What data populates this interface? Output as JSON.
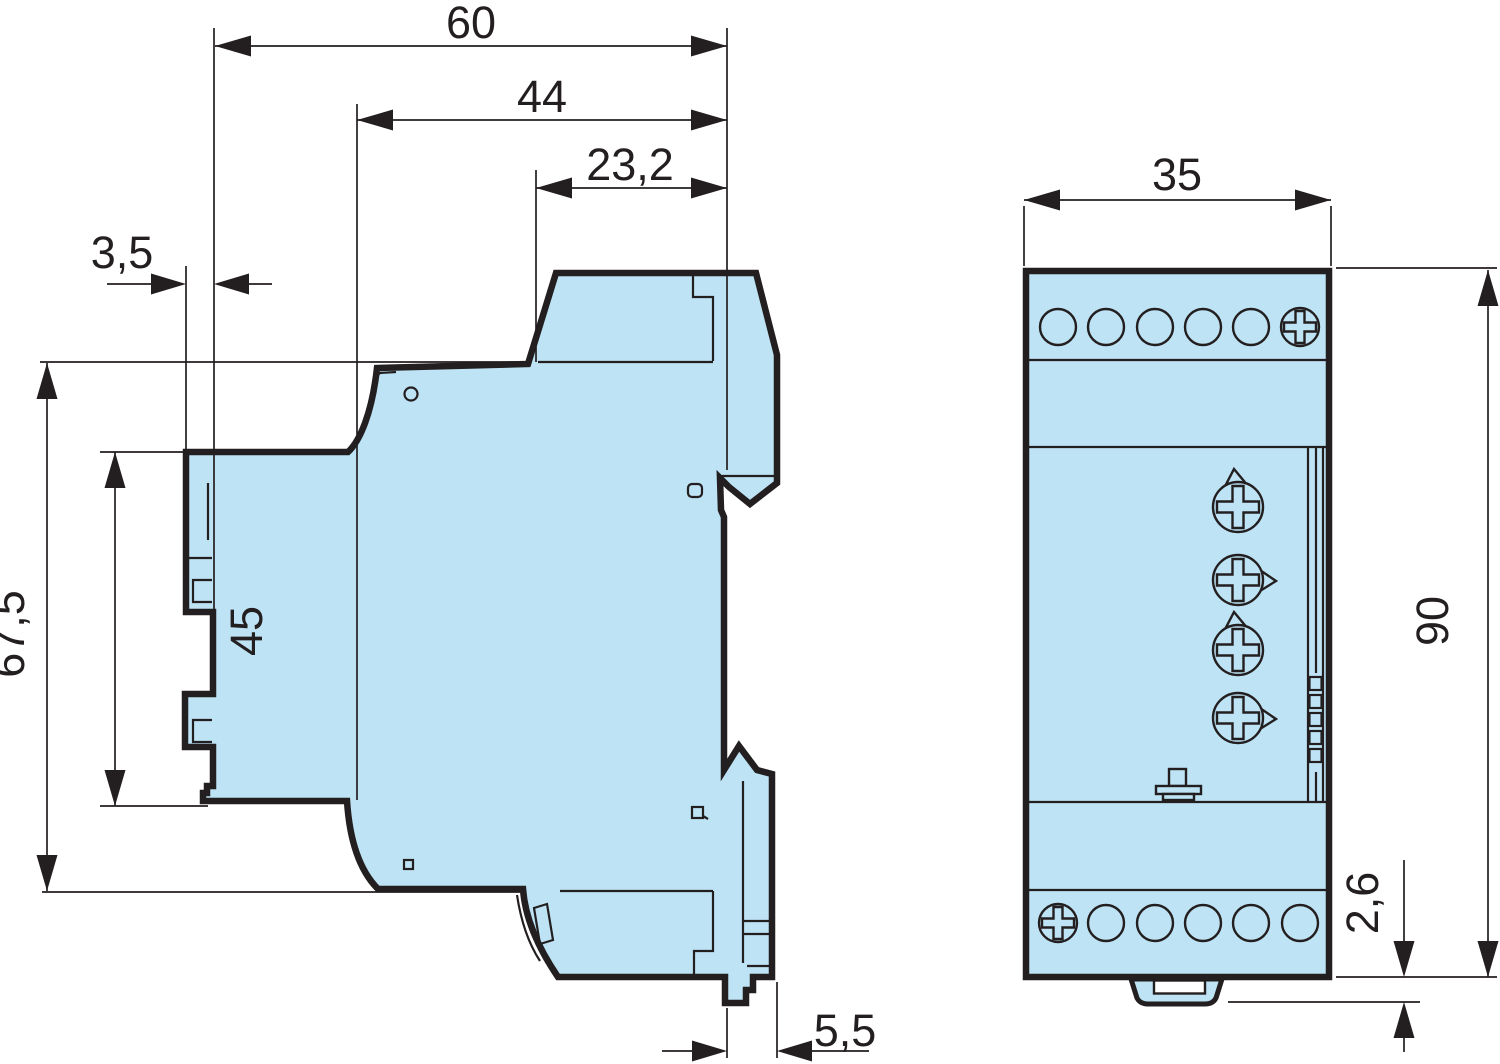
{
  "colors": {
    "device_fill": "#BEE3F4",
    "line": "#231F20",
    "background": "#FFFFFF"
  },
  "side_view": {
    "dim_total_width": "60",
    "dim_upper_width": "44",
    "dim_top_width": "23,2",
    "dim_mount_offset": "3,5",
    "dim_total_height": "67,5",
    "dim_front_height": "45",
    "dim_clip_offset": "5,5"
  },
  "front_view": {
    "dim_width": "35",
    "dim_height": "90",
    "dim_clip_depth": "2,6"
  }
}
